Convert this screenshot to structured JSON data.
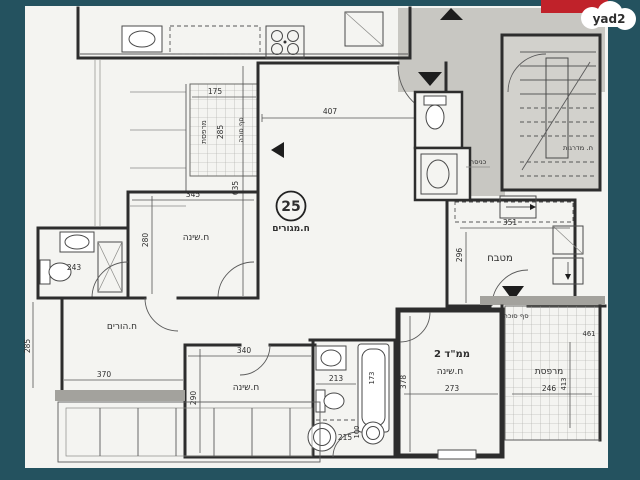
{
  "watermark": {
    "brand": "yad2"
  },
  "plan": {
    "unit": {
      "number": "25"
    },
    "living": {
      "label": "ח.מגורים",
      "dim_w": "407",
      "dim_h": "635"
    },
    "bedroom_top": {
      "label": "ח.שינה",
      "dim_w": "345",
      "dim_h": "280"
    },
    "bathroom_left": {
      "dim": "243"
    },
    "parents_room": {
      "label": "ח.הורים",
      "dim_w": "370",
      "dim_h": "285"
    },
    "bedroom_bottom": {
      "label": "ח.שינה",
      "dim_w": "340",
      "dim_h": "290"
    },
    "bathroom_bottom": {
      "dim_a": "213",
      "dim_b": "215",
      "dim_c": "100",
      "tub_dim": "173"
    },
    "mamad": {
      "label": "ממ\"ד 2",
      "sublabel": "ח.שינה",
      "dim_w": "273",
      "dim_h": "378"
    },
    "kitchen": {
      "label": "מטבח",
      "dim_w": "351",
      "dim_h": "296"
    },
    "stairs": {
      "label": "ח. מדרגות"
    },
    "entrance": {
      "label": "כניסה"
    },
    "balcony_top": {
      "label": "מרפסת",
      "sill_label": "סף סוכה",
      "dim_w": "175",
      "dim_h": "285"
    },
    "balcony_bottom": {
      "label": "מרפסת",
      "sill_label": "סף סוכה",
      "dim_w": "246",
      "dim_h": "413",
      "dim_edge": "461"
    }
  },
  "colors": {
    "background": "#24525f",
    "paper": "#f4f4f1",
    "common": "#c8c7c2",
    "stair_fill": "#d2d1cc",
    "accent_red": "#c0222a",
    "ink": "#2e2e2e"
  }
}
